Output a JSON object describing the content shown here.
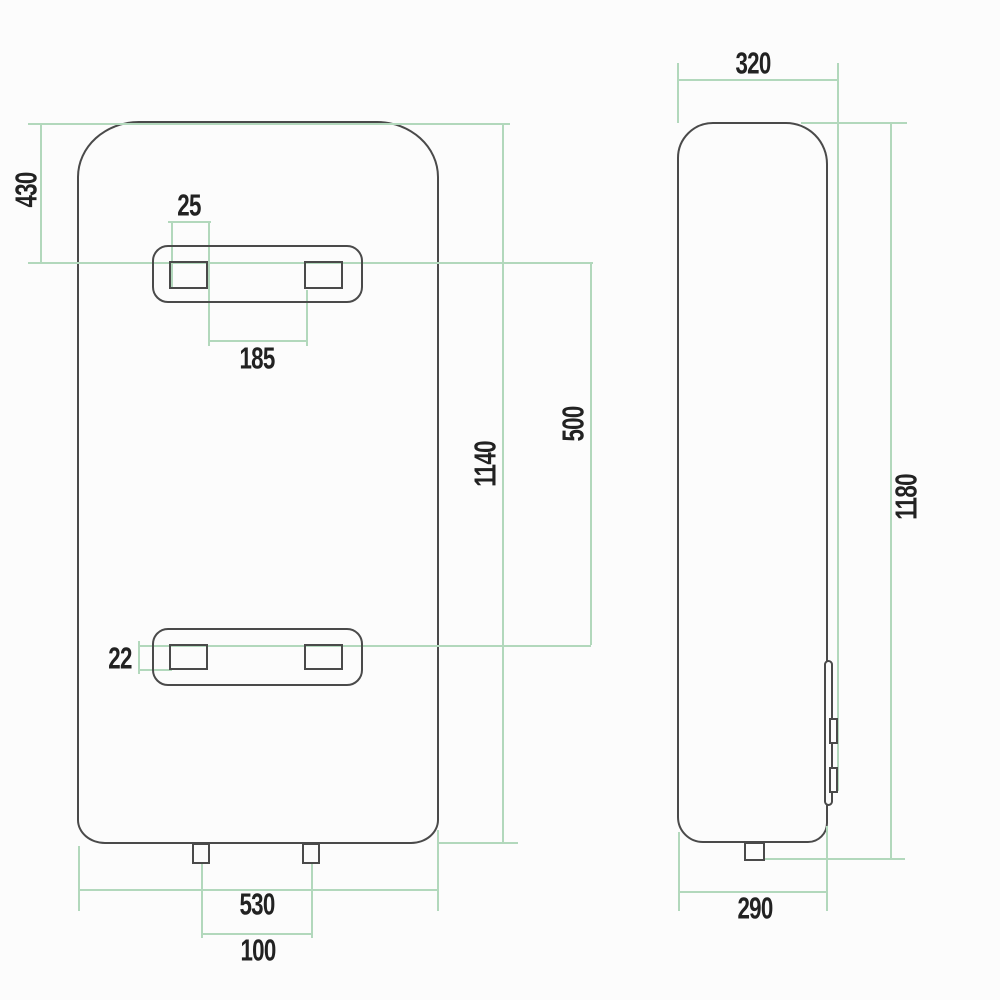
{
  "drawing": {
    "subject": "Two-view dimension drawing of a vertical wall-mounted water heater",
    "views": {
      "front": {
        "name": "front view",
        "dims": {
          "top_to_upper_bracket": "430",
          "slot_width": "25",
          "slot_inner_spacing": "185",
          "body_height": "1140",
          "bracket_vertical_spacing": "500",
          "slot_height": "22",
          "body_width": "530",
          "pipe_spacing": "100"
        }
      },
      "side": {
        "name": "side view",
        "dims": {
          "depth_overall_with_brackets": "320",
          "overall_height_with_pipe": "1180",
          "body_depth": "290"
        }
      }
    }
  },
  "colors": {
    "background": "#fcfcfc",
    "outline": "#4a4a4a",
    "dimension_line": "#b2d8bc",
    "label": "#222222"
  }
}
